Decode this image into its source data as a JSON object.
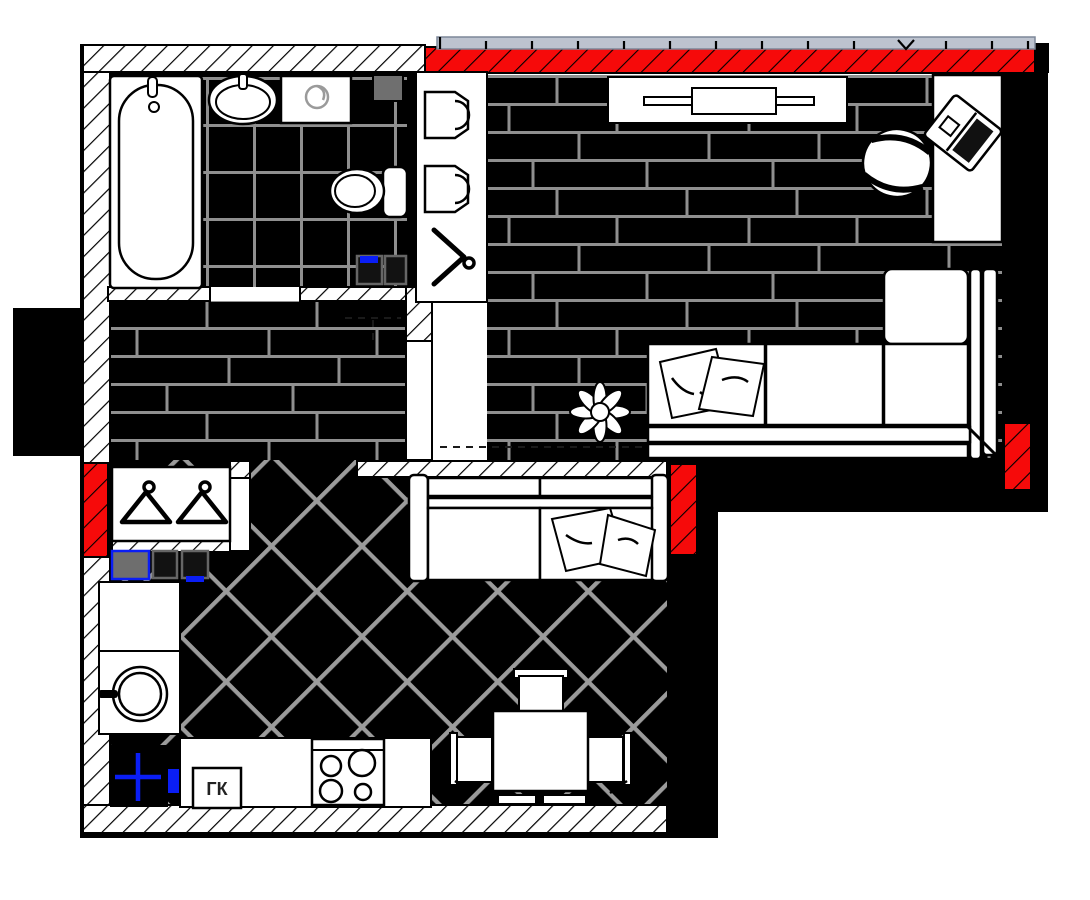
{
  "theme": {
    "red": "#f60a0a",
    "blue": "#0a1ef5",
    "seam": "#8f8f8f",
    "lattice": "#9b9b9b",
    "window": "#bdc3cf",
    "gray_box": "#6e6e6e",
    "glyph_gray": "#9a9a9a"
  },
  "labels": {
    "gas_boiler": "ГК"
  },
  "fixtures": [
    "bathtub",
    "washbasin",
    "washing-machine",
    "ventilation-box",
    "toilet",
    "boiler-boxes",
    "storage-shelf",
    "wardrobe-hanger",
    "tv-stand",
    "tv",
    "desk",
    "laptop",
    "office-chair",
    "corner-sofa",
    "cushions",
    "plant",
    "coat-rack",
    "coat-hangers",
    "switchboard-boxes",
    "kitchen-counter",
    "round-sink",
    "gas-riser",
    "gas-boiler",
    "cooktop",
    "dining-table",
    "dining-chairs",
    "kitchen-sofa",
    "entry-window",
    "balcony-glazing"
  ]
}
